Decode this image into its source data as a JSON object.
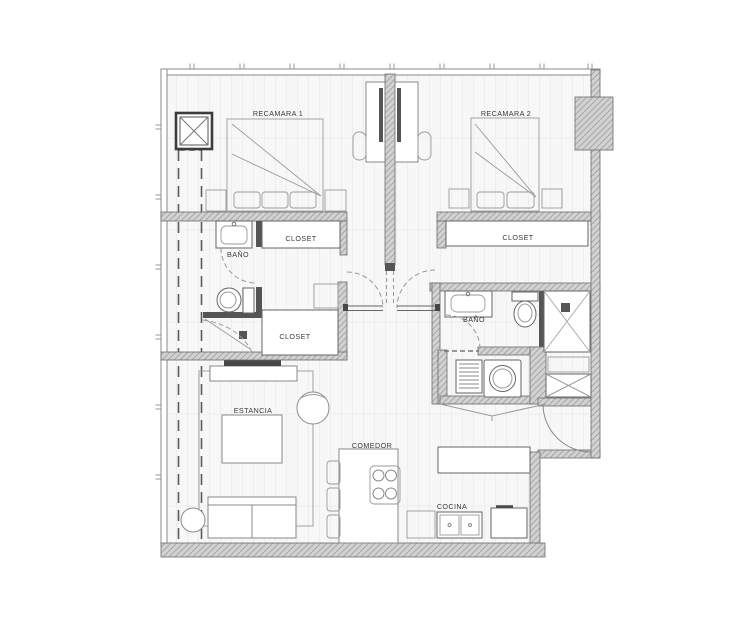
{
  "plan": {
    "type": "apartment-floor-plan",
    "rooms": {
      "recamara1": "RECAMARA 1",
      "recamara2": "RECAMARA 2",
      "closet_r1": "CLOSET",
      "closet_hall": "CLOSET",
      "closet_r2": "CLOSET",
      "bano1": "BAÑO",
      "bano2": "BAÑO",
      "estancia": "ESTANCIA",
      "comedor": "COMEDOR",
      "cocina": "COCINA"
    },
    "colors": {
      "background": "#ffffff",
      "wall_fill": "#d2d2d2",
      "wall_hatch": "#a8a8a8",
      "wall_line": "#6b6b6b",
      "floor": "#f7f7f7",
      "floor_plank_line": "#e4e4e4",
      "furniture_line": "#8a8a8a",
      "fixture_dark": "#555555",
      "label_text": "#3a3a3a"
    }
  }
}
